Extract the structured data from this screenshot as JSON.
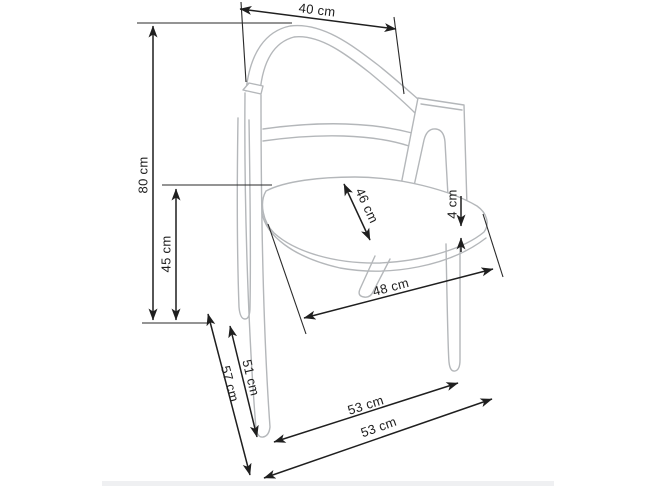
{
  "diagram": {
    "type": "furniture-dimension-drawing",
    "subject": "armchair-technical-sketch",
    "labels": {
      "back_width_top": "40 cm",
      "total_height": "80 cm",
      "seat_height": "45 cm",
      "seat_depth": "46 cm",
      "seat_thickness": "4 cm",
      "seat_width": "48 cm",
      "front_leg_length": "51 cm",
      "front_edge_to_floor": "57 cm",
      "depth_upper": "53 cm",
      "depth_lower": "53 cm"
    },
    "colors": {
      "background": "#ffffff",
      "chair_line": "#b4b7ba",
      "dimension_line": "#1f1f1f",
      "label_text": "#1d1d1d",
      "footer_bar": "#eff0f2"
    }
  }
}
